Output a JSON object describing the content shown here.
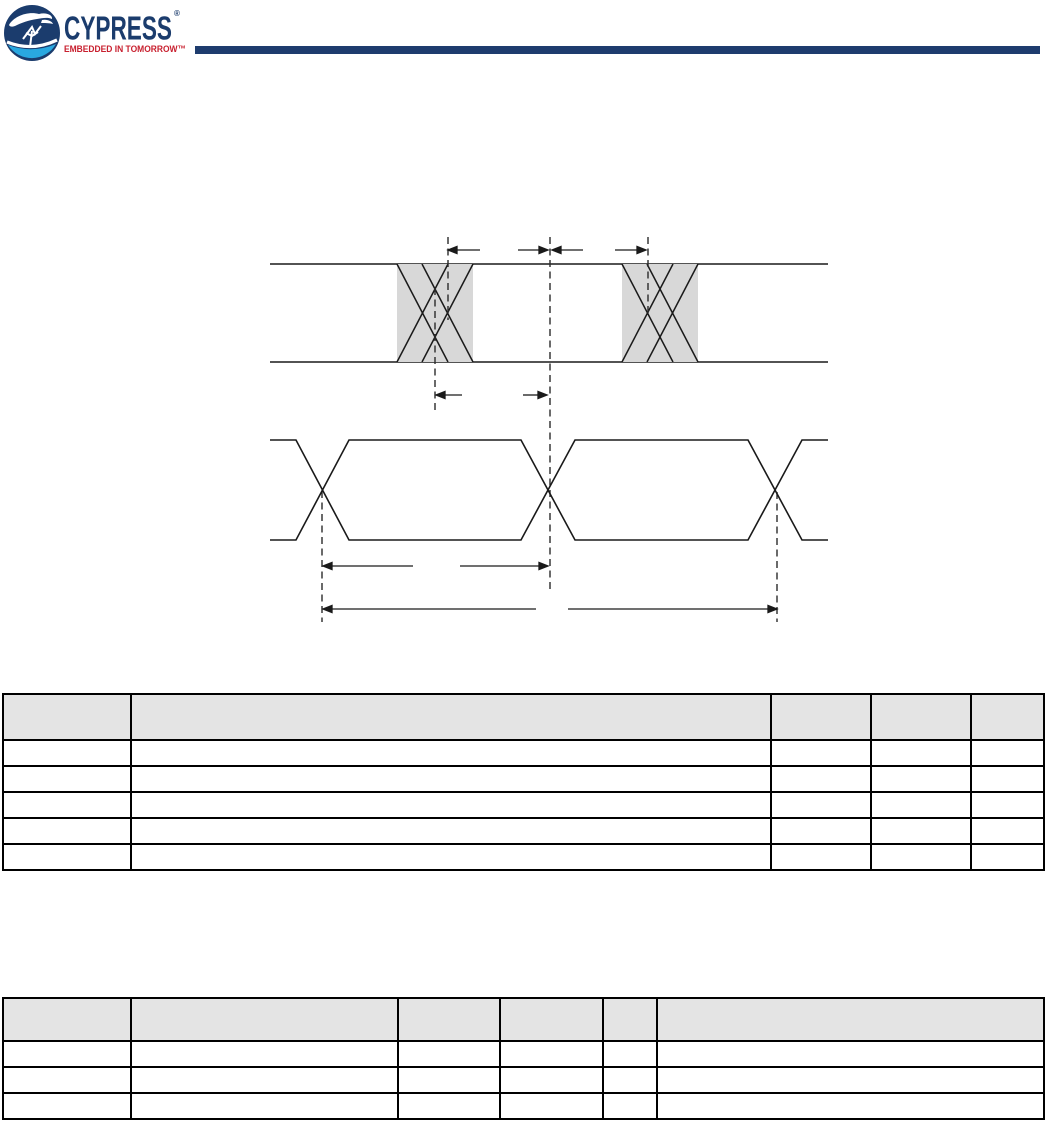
{
  "page": {
    "background": "#ffffff"
  },
  "header": {
    "brand": "CYPRESS",
    "registered_mark": "®",
    "tagline": "EMBEDDED IN TOMORROW™",
    "colors": {
      "brand_navy": "#1b3c6d",
      "brand_cyan": "#29a8e0",
      "tagline_red": "#c8202f",
      "rule_bar_navy": "#1e3c6e"
    }
  },
  "figure": {
    "kind": "timing-waveform-diagram",
    "line_color": "#1a1a1a",
    "dashed_guide_color": "#2b2b2b",
    "hatch_fill": "#d8d8d8",
    "upper_signal": "bus with two cross-hatched transition regions",
    "lower_signal": "clock/data eye pattern with three crossings",
    "dimension_arrow_pairs": 5,
    "labels": []
  },
  "tables": {
    "table_1": {
      "header_fill": "#e4e4e4",
      "column_count": 5,
      "header_cells": [
        "",
        "",
        "",
        "",
        ""
      ],
      "rows": [
        [
          "",
          "",
          "",
          "",
          ""
        ],
        [
          "",
          "",
          "",
          "",
          ""
        ],
        [
          "",
          "",
          "",
          "",
          ""
        ],
        [
          "",
          "",
          "",
          "",
          ""
        ],
        [
          "",
          "",
          "",
          "",
          ""
        ]
      ]
    },
    "table_2": {
      "header_fill": "#e4e4e4",
      "column_count": 6,
      "header_cells": [
        "",
        "",
        "",
        "",
        "",
        ""
      ],
      "rows": [
        [
          "",
          "",
          "",
          "",
          "",
          ""
        ],
        [
          "",
          "",
          "",
          "",
          "",
          ""
        ],
        [
          "",
          "",
          "",
          "",
          "",
          ""
        ]
      ]
    }
  }
}
